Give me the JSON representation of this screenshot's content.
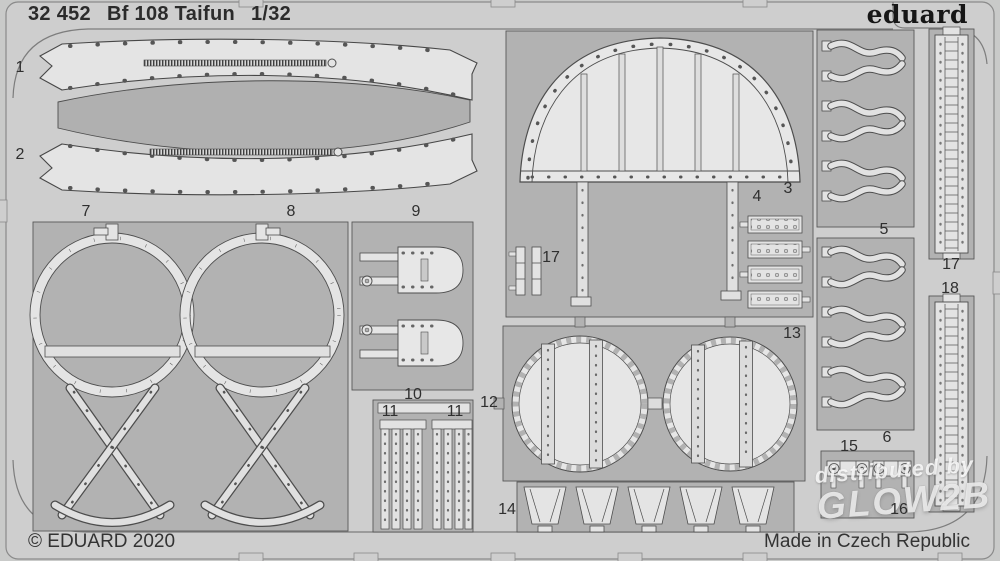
{
  "header": {
    "catalog_number": "32 452",
    "product_name": "Bf 108 Taifun",
    "scale": "1/32",
    "brand": "eduard"
  },
  "footer": {
    "copyright": "© EDUARD 2020",
    "made_in": "Made in Czech Republic"
  },
  "watermark": {
    "line1": "distributed by",
    "line2": "GLOW2B"
  },
  "sheet": {
    "type": "photo-etched parts fret",
    "colors": {
      "fret_metal": "#cecece",
      "etched_window": "#b2b2b2",
      "part_fill": "#e5e5e5",
      "outline": "#4d4d4d",
      "text": "#2d2d2d"
    },
    "part_labels": [
      {
        "text": "1"
      },
      {
        "text": "2"
      },
      {
        "text": "7"
      },
      {
        "text": "8"
      },
      {
        "text": "9"
      },
      {
        "text": "3"
      },
      {
        "text": "4"
      },
      {
        "text": "17"
      },
      {
        "text": "5"
      },
      {
        "text": "6"
      },
      {
        "text": "17"
      },
      {
        "text": "18"
      },
      {
        "text": "13"
      },
      {
        "text": "12"
      },
      {
        "text": "10"
      },
      {
        "text": "11"
      },
      {
        "text": "11"
      },
      {
        "text": "14"
      },
      {
        "text": "15"
      },
      {
        "text": "16"
      }
    ]
  }
}
